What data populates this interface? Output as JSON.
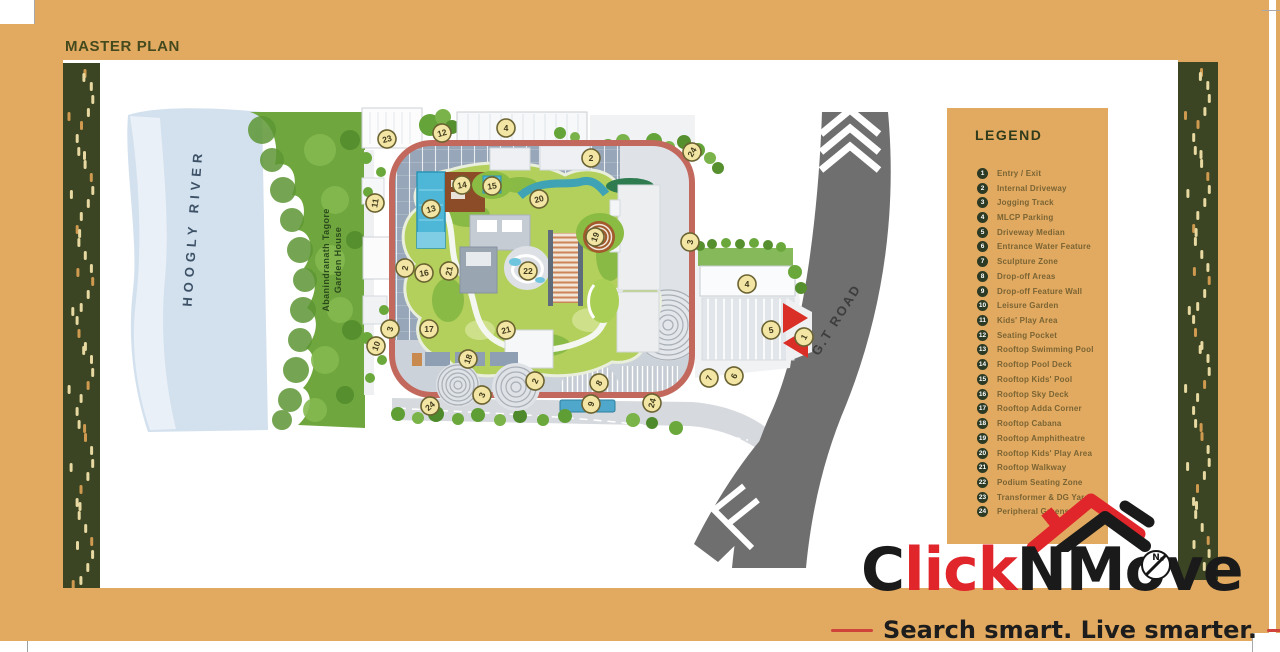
{
  "page": {
    "title": "MASTER PLAN"
  },
  "legend": {
    "title": "LEGEND",
    "items": [
      "Entry / Exit",
      "Internal Driveway",
      "Jogging Track",
      "MLCP Parking",
      "Driveway Median",
      "Entrance Water Feature",
      "Sculpture Zone",
      "Drop-off Areas",
      "Drop-off Feature Wall",
      "Leisure Garden",
      "Kids' Play Area",
      "Seating Pocket",
      "Rooftop Swimming Pool",
      "Rooftop Pool Deck",
      "Rooftop Kids' Pool",
      "Rooftop Sky Deck",
      "Rooftop Adda Corner",
      "Rooftop Cabana",
      "Rooftop Amphitheatre",
      "Rooftop Kids' Play Area",
      "Rooftop Walkway",
      "Podium Seating Zone",
      "Transformer & DG Yard",
      "Peripheral Greens"
    ]
  },
  "map": {
    "labels": {
      "river": "HOOGLY RIVER",
      "garden_house_line1": "Abanindranath Tagore",
      "garden_house_line2": "Garden House",
      "road": "G.T ROAD"
    },
    "markers": [
      {
        "n": "23",
        "x": 387,
        "y": 139,
        "r": -15
      },
      {
        "n": "12",
        "x": 442,
        "y": 133,
        "r": -15
      },
      {
        "n": "4",
        "x": 506,
        "y": 128,
        "r": 0
      },
      {
        "n": "2",
        "x": 591,
        "y": 158,
        "r": 0
      },
      {
        "n": "24",
        "x": 692,
        "y": 152,
        "r": -60
      },
      {
        "n": "11",
        "x": 375,
        "y": 203,
        "r": -80
      },
      {
        "n": "14",
        "x": 462,
        "y": 185,
        "r": -10
      },
      {
        "n": "15",
        "x": 492,
        "y": 186,
        "r": -10
      },
      {
        "n": "13",
        "x": 431,
        "y": 209,
        "r": -15
      },
      {
        "n": "20",
        "x": 539,
        "y": 199,
        "r": -15
      },
      {
        "n": "19",
        "x": 595,
        "y": 237,
        "r": -70
      },
      {
        "n": "3",
        "x": 690,
        "y": 242,
        "r": -80
      },
      {
        "n": "2",
        "x": 405,
        "y": 268,
        "r": -80
      },
      {
        "n": "16",
        "x": 424,
        "y": 273,
        "r": -10
      },
      {
        "n": "21",
        "x": 449,
        "y": 271,
        "r": -80
      },
      {
        "n": "22",
        "x": 528,
        "y": 271,
        "r": 0
      },
      {
        "n": "17",
        "x": 429,
        "y": 329,
        "r": 0
      },
      {
        "n": "3",
        "x": 390,
        "y": 329,
        "r": -75
      },
      {
        "n": "10",
        "x": 376,
        "y": 346,
        "r": -70
      },
      {
        "n": "21",
        "x": 506,
        "y": 330,
        "r": -15
      },
      {
        "n": "18",
        "x": 468,
        "y": 359,
        "r": -70
      },
      {
        "n": "2",
        "x": 535,
        "y": 381,
        "r": -65
      },
      {
        "n": "3",
        "x": 482,
        "y": 395,
        "r": -65
      },
      {
        "n": "8",
        "x": 599,
        "y": 383,
        "r": -60
      },
      {
        "n": "9",
        "x": 591,
        "y": 404,
        "r": -75
      },
      {
        "n": "7",
        "x": 709,
        "y": 378,
        "r": -65
      },
      {
        "n": "6",
        "x": 734,
        "y": 376,
        "r": -65
      },
      {
        "n": "24",
        "x": 430,
        "y": 406,
        "r": -40
      },
      {
        "n": "24",
        "x": 652,
        "y": 403,
        "r": -75
      },
      {
        "n": "4",
        "x": 747,
        "y": 284,
        "r": 0
      },
      {
        "n": "5",
        "x": 771,
        "y": 330,
        "r": -10
      },
      {
        "n": "1",
        "x": 804,
        "y": 337,
        "r": -60
      }
    ]
  },
  "logo": {
    "part1": "C",
    "part2": "lick",
    "part3": "NMove",
    "compass": "N",
    "tagline": "Search smart. Live smarter."
  },
  "colors": {
    "background": "#e2aa60",
    "strip_green": "#3b4523",
    "heading": "#454a1e",
    "legend_text": "#7a6434",
    "legend_badge": "#2c3a24",
    "track_red": "#c2685c",
    "road_gray": "#6f6f6f",
    "river_blue": "#d3e1ee",
    "bank_green": "#6fa63e",
    "marker_fill": "#f3e5a4",
    "marker_stroke": "#6b6331",
    "logo_red": "#e0252b",
    "logo_black": "#1a1a1a",
    "tagline_dash": "#d0433a"
  }
}
